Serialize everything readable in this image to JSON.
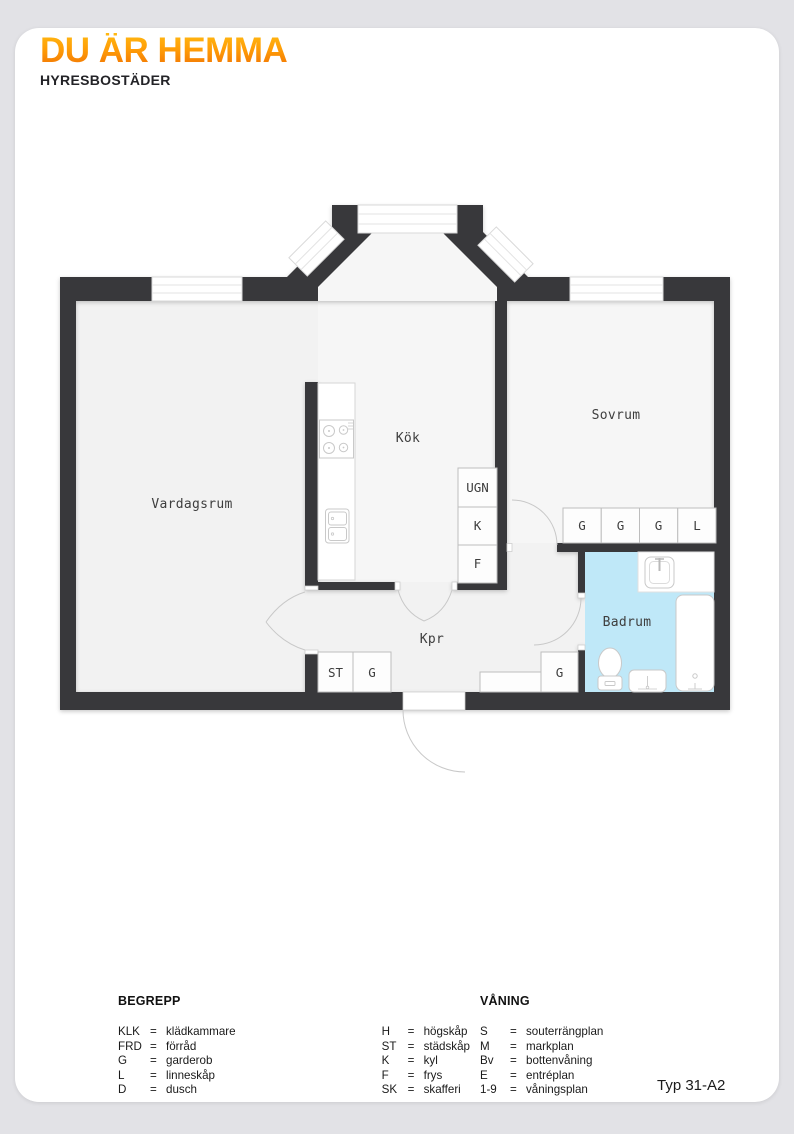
{
  "brand": {
    "logo": "DU ÄR HEMMA",
    "tagline": "HYRESBOSTÄDER",
    "logo_gradient_top": "#ffb912",
    "logo_gradient_bottom": "#f07104"
  },
  "plan": {
    "room_labels": {
      "vardagsrum": "Vardagsrum",
      "kok": "Kök",
      "sovrum": "Sovrum",
      "kpr": "Kpr",
      "badrum": "Badrum"
    },
    "cabinet_labels": {
      "ugn": "UGN",
      "kyl": "K",
      "frys": "F",
      "bed_g1": "G",
      "bed_g2": "G",
      "bed_g3": "G",
      "bed_l": "L",
      "hall_st": "ST",
      "hall_g1": "G",
      "hall_g2": "G"
    },
    "fixtures": {
      "stove": "4-burner cooktop",
      "kitchen_sink": "double-basin sink",
      "bathroom_sink": "sink with faucet",
      "bathtub": "bathtub",
      "toilet": "toilet",
      "washbasin": "washbasin"
    },
    "colors": {
      "wall": "#38383a",
      "floor": "#f2f2f2",
      "floor_light": "#f6f6f6",
      "bathroom_floor": "#bfe8f8"
    }
  },
  "legend": {
    "eq": "=",
    "begrepp": {
      "title": "BEGREPP",
      "col1": [
        {
          "abbr": "KLK",
          "def": "klädkammare"
        },
        {
          "abbr": "FRD",
          "def": "förråd"
        },
        {
          "abbr": "G",
          "def": "garderob"
        },
        {
          "abbr": "L",
          "def": "linneskåp"
        },
        {
          "abbr": "D",
          "def": "dusch"
        }
      ],
      "col2": [
        {
          "abbr": "H",
          "def": "högskåp"
        },
        {
          "abbr": "ST",
          "def": "städskåp"
        },
        {
          "abbr": "K",
          "def": "kyl"
        },
        {
          "abbr": "F",
          "def": "frys"
        },
        {
          "abbr": "SK",
          "def": "skafferi"
        }
      ]
    },
    "vaning": {
      "title": "VÅNING",
      "items": [
        {
          "abbr": "S",
          "def": "souterrängplan"
        },
        {
          "abbr": "M",
          "def": "markplan"
        },
        {
          "abbr": "Bv",
          "def": "bottenvåning"
        },
        {
          "abbr": "E",
          "def": "entréplan"
        },
        {
          "abbr": "1-9",
          "def": "våningsplan"
        }
      ]
    }
  },
  "type_label": "Typ 31-A2"
}
